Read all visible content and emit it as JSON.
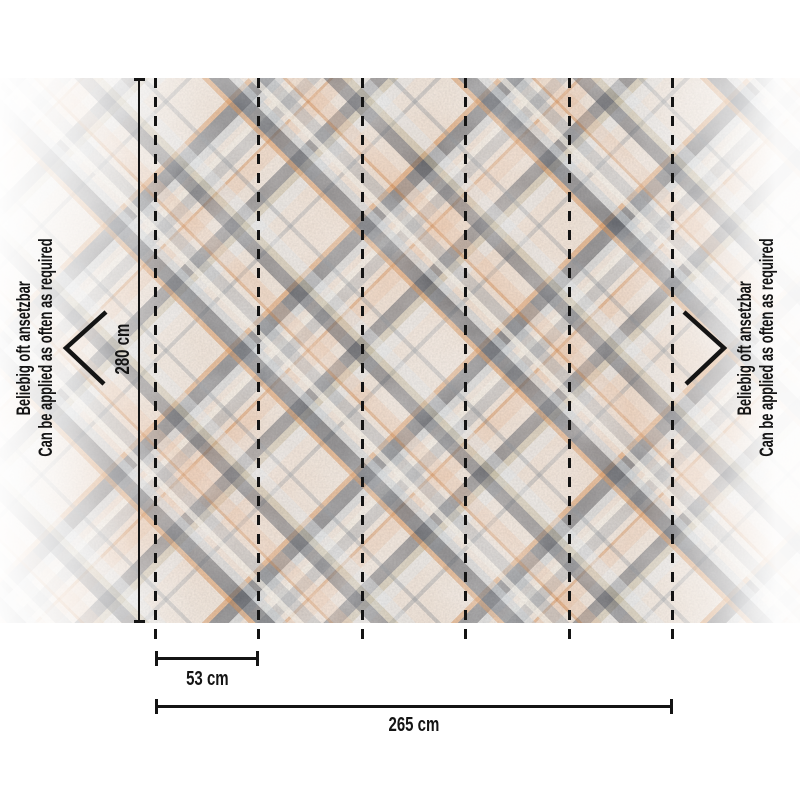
{
  "diagram": {
    "type": "wallpaper mural dimension diagram",
    "panels_visible": 5,
    "measurements": {
      "height": "280 cm",
      "panel_width": "53 cm",
      "total_width": "265 cm"
    },
    "side_note": {
      "de": "Beliebig oft ansetzbar",
      "en": "Can be applied as often as required"
    },
    "icons": {
      "left": "chevron-left-icon",
      "right": "chevron-right-icon"
    },
    "pattern_palette": {
      "base": "#f2e4d7",
      "dark_charcoal": "#3c424c",
      "slate_gray": "#8e969e",
      "light_blue_gray": "#c4cdd3",
      "cream": "#f6f0e4",
      "orange": "#d67e34",
      "salmon": "#eeb992",
      "tan": "#b2aa88",
      "annotation_line": "#141414"
    }
  }
}
